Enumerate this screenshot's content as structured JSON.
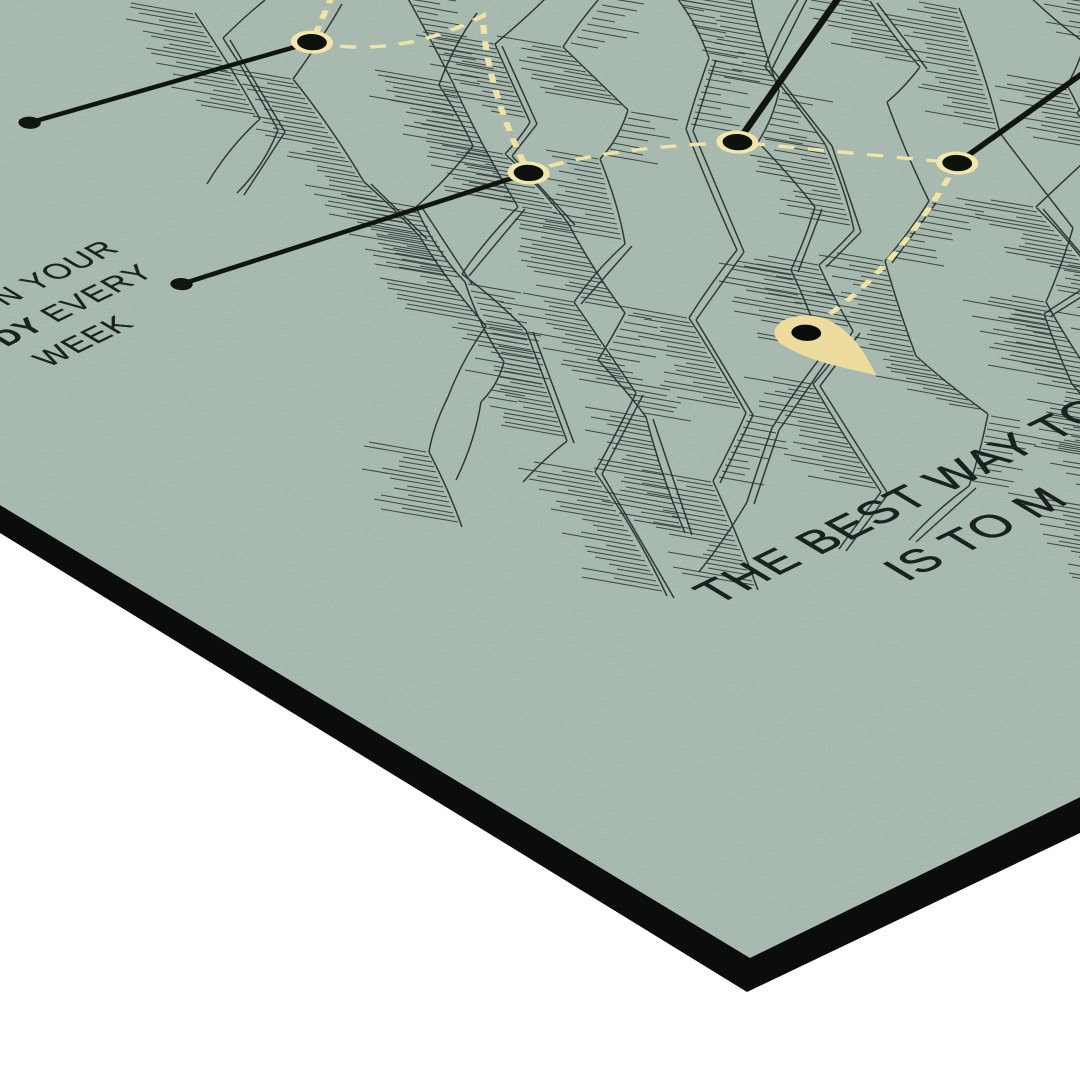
{
  "scene": {
    "backdrop_color": "#ffffff",
    "board_color": "#0b0c0c",
    "poster_color": "#a8bab0"
  },
  "poster": {
    "ink_color": "#22302a",
    "line_color": "#101510",
    "route_color": "#efe3a6",
    "ring_color": "#f2e6ab",
    "pin_color": "#eedc9e",
    "callout_label": {
      "line1": "N YOUR",
      "line2_bold": "ODY",
      "line2_rest": " EVERY",
      "line3": "WEEK"
    },
    "quote": {
      "line1": "THE BEST WAY TO",
      "line2": "IS TO M"
    }
  },
  "map": {
    "route_path": "M745,198 L664,251 Q700,315 796,312 Q725,390 664,504 Q730,512 824,580 L938,717 Q800,795 706,812",
    "waypoints": [
      [
        664,
        251
      ],
      [
        664,
        504
      ],
      [
        824,
        580
      ],
      [
        938,
        717
      ]
    ],
    "terminals": [
      [
        408,
        190
      ],
      [
        337,
        442
      ]
    ],
    "callouts": [
      [
        408,
        190,
        664,
        251
      ],
      [
        337,
        442,
        664,
        504
      ],
      [
        824,
        580,
        1180,
        407
      ],
      [
        938,
        717,
        1280,
        655
      ]
    ],
    "pin": {
      "x": 672,
      "y": 822
    }
  },
  "art": {
    "seed": 9,
    "spine_count": 14
  }
}
